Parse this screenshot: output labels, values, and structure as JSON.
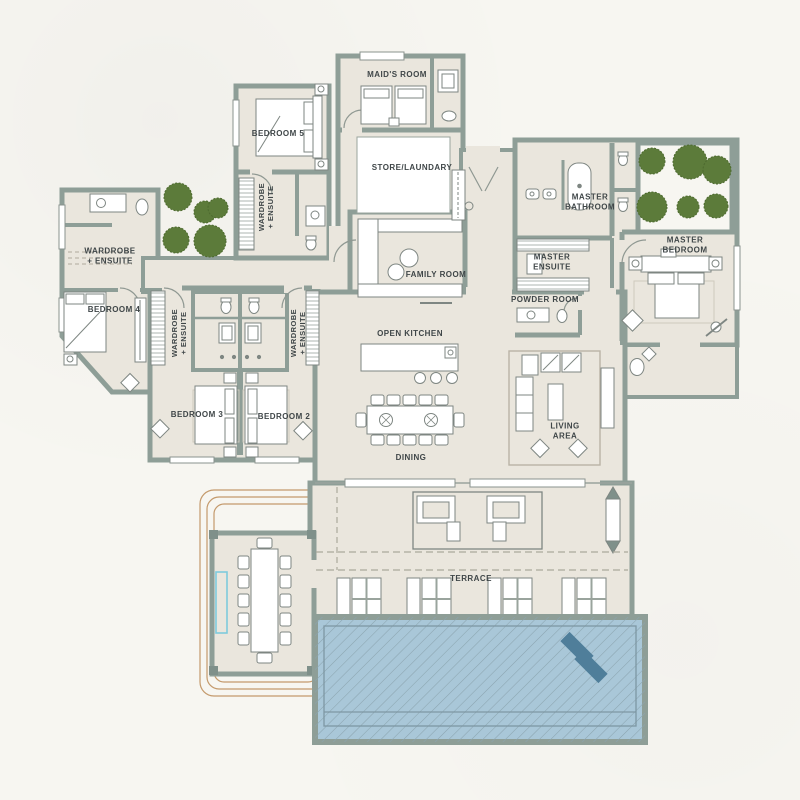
{
  "type": "architectural-floor-plan",
  "rooms": {
    "maids_room": "MAID'S ROOM",
    "bedroom_5": "BEDROOM 5",
    "store_laundry": "STORE/LAUNDARY",
    "wardrobe_ensuite": "WARDROBE\n+ ENSUITE",
    "family_room": "FAMILY ROOM",
    "master_bathroom": "MASTER\nBATHROOM",
    "master_ensuite": "MASTER\nENSUITE",
    "master_bedroom": "MASTER\nBEDROOM",
    "powder_room": "POWDER ROOM",
    "bedroom_4": "BEDROOM 4",
    "bedroom_3": "BEDROOM 3",
    "bedroom_2": "BEDROOM 2",
    "open_kitchen": "OPEN KITCHEN",
    "dining": "DINING",
    "living_area": "LIVING\nAREA",
    "terrace": "TERRACE"
  },
  "colors": {
    "background": "#f7f6f1",
    "floor": "#eae6dd",
    "wall": "#8e9e97",
    "pool_water": "#a9c7d8",
    "pool_lounger": "#4f7e9a",
    "tree_green": "#5c7b3a",
    "path_accent": "#c49a6c",
    "cyan_accent": "#7ecbdd",
    "label_text": "#3f4648"
  }
}
